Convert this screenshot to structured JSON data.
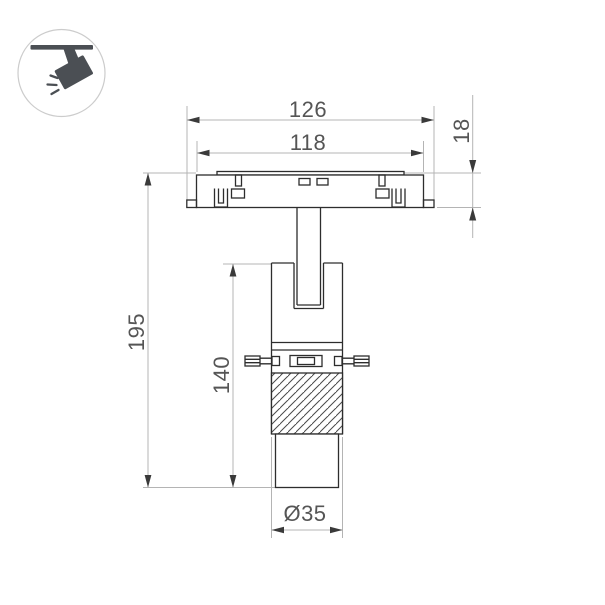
{
  "page": {
    "background": "#ffffff"
  },
  "legend": {
    "icon": "track-spotlight-icon"
  },
  "dims": {
    "outer_width": "126",
    "inner_width": "118",
    "track_height": "18",
    "total_height": "195",
    "body_height": "140",
    "diameter": "Ø35"
  },
  "colors": {
    "outline": "#2d2d2d",
    "extension_line": "#b4b4b4",
    "arrow": "#3a3a3a",
    "dim_text": "#555555",
    "icon": "#4b4f54",
    "icon_circle_stroke": "#cccccc"
  }
}
